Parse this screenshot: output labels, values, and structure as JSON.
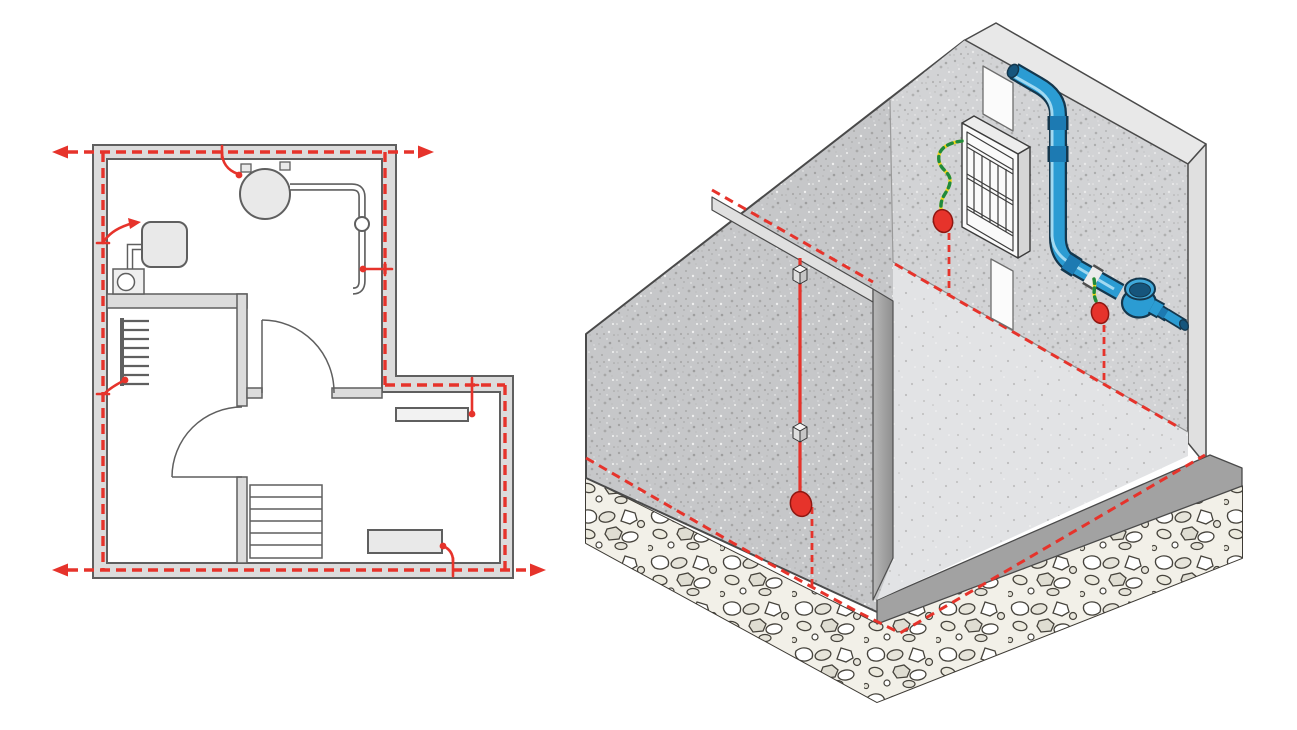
{
  "canvas": {
    "width": 1297,
    "height": 730,
    "background": "#ffffff"
  },
  "colors": {
    "conductor_red": "#e6332b",
    "terminal_red": "#e6332b",
    "terminal_red_edge": "#8f1711",
    "wire_yellow": "#f2d51a",
    "wire_green": "#1f8a3d",
    "pipe_blue": "#2b9cd3",
    "pipe_blue_dark": "#1d7ab2",
    "pipe_blue_deep": "#16557c",
    "pipe_outline": "#14374d",
    "pipe_highlight": "#a8dcf2",
    "clamp_white": "#ececec",
    "plan_wall_fill": "#dcdcdc",
    "plan_wall_stroke": "#5f5f5f",
    "plan_fixture_fill": "#e9e9e9",
    "concrete_left": "#c6c7c9",
    "concrete_right": "#d2d3d5",
    "concrete_floor": "#e2e3e5",
    "concrete_edge": "#4a4a4a",
    "wall_top_band": "#e8e8e8",
    "wall_end_band": "#e0e0e0",
    "ledge_band": "#e0e0e0",
    "skirt_gray": "#a2a2a2",
    "rubble_bg": "#f2f0e8",
    "rubble_stroke": "#46433c",
    "panel_white": "#fafafa",
    "panel_side": "#d6d6d6",
    "panel_top": "#ececec",
    "panel_grid": "#3c3c3c",
    "duct_white": "#fbfbfb"
  },
  "floor_plan": {
    "name": "equipotential-bonding-ring-floor-plan",
    "ring_conductor": {
      "style": "dashed",
      "color": "#e6332b",
      "outward_arrows": 4
    },
    "bonded_items": [
      {
        "id": "water-heater",
        "type": "storage water heater (circle) with pipe run"
      },
      {
        "id": "wall-boiler",
        "type": "wall appliance with pump unit"
      },
      {
        "id": "water-pipe-valve",
        "type": "pipe run with shut-off valve"
      },
      {
        "id": "radiator-left",
        "type": "sectional radiator"
      },
      {
        "id": "radiator-right",
        "type": "panel radiator"
      },
      {
        "id": "electric-appliance",
        "type": "floor-standing appliance"
      }
    ],
    "building": {
      "doors": 2,
      "stair_steps": 6,
      "rooms": 3
    }
  },
  "isometric_view": {
    "name": "foundation-earth-electrode-basement-corner",
    "foundation_ring": {
      "style": "dashed",
      "color": "#e6332b",
      "location": "in rubble foundation"
    },
    "wall_base_ring": {
      "style": "dashed",
      "color": "#e6332b",
      "location": "wall/floor junction"
    },
    "down_conductor": {
      "style": "solid",
      "color": "#e6332b",
      "clamps": 2
    },
    "earth_terminals": 3,
    "bonding_wires": [
      {
        "id": "distribution-board-earth",
        "stripe_colors": [
          "#1f8a3d",
          "#f2d51a"
        ]
      },
      {
        "id": "water-pipe-clamp-earth",
        "stripe_colors": [
          "#1f8a3d",
          "#f2d51a"
        ]
      }
    ],
    "equipment": [
      {
        "id": "distribution-board",
        "grid": "2 rows x 5 modules"
      },
      {
        "id": "cable-duct",
        "color": "#fbfbfb"
      },
      {
        "id": "water-supply-pipe",
        "color": "#2b9cd3"
      },
      {
        "id": "water-meter",
        "color": "#2b9cd3"
      },
      {
        "id": "pipe-bonding-clamp",
        "color": "#ececec"
      }
    ]
  }
}
